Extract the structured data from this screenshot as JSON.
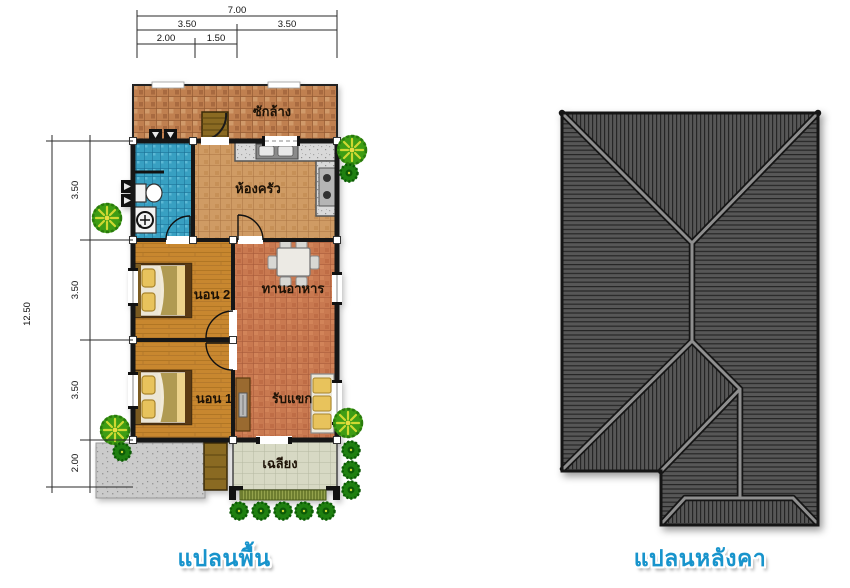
{
  "captions": {
    "floor_plan": "แปลนพื้น",
    "roof_plan": "แปลนหลังคา"
  },
  "rooms": {
    "laundry": "ซักล้าง",
    "kitchen": "ห้องครัว",
    "dining": "ทานอาหาร",
    "bedroom2": "นอน 2",
    "bedroom1": "นอน 1",
    "living": "รับแขก",
    "porch": "เฉลียง"
  },
  "dimensions": {
    "top": {
      "total": "7.00",
      "left_half": "3.50",
      "right_half": "3.50",
      "sub_left": "2.00",
      "sub_right": "1.50"
    },
    "left": {
      "total": "12.50",
      "upper": "3.50",
      "middle": "3.50",
      "lower": "3.50",
      "bottom": "2.00"
    }
  },
  "colors": {
    "caption_blue": "#1894cc",
    "roof_gray": "#575757",
    "laundry_tile": "#c08050",
    "kitchen_tile": "#cf9b64",
    "bathroom_tile": "#38a0c2",
    "bedroom_wood": "#c8872f",
    "living_tile": "#c97950",
    "porch_tile": "#d7d9c4",
    "concrete": "#cccccc",
    "tree_green": "#3e9d14"
  }
}
